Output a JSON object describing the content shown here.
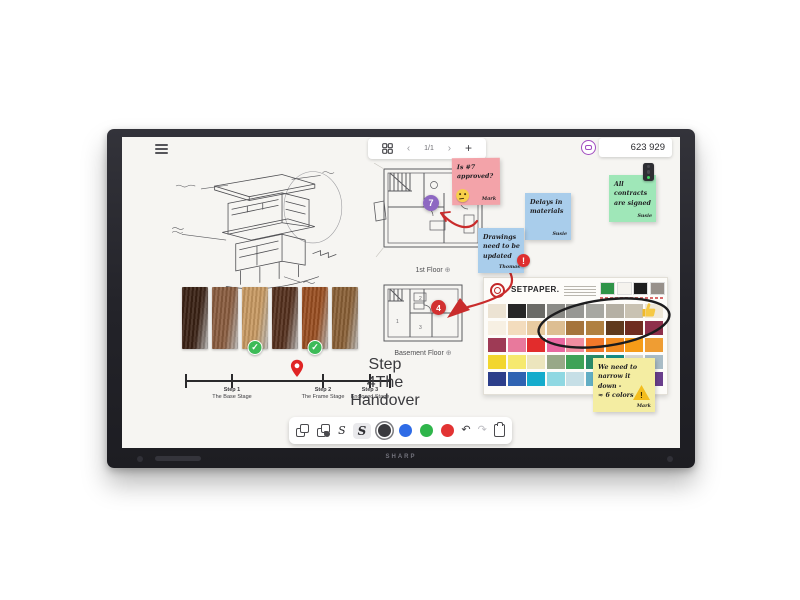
{
  "device": {
    "brand_label": "SHARP"
  },
  "topbar": {
    "prev_icon": "‹",
    "page_indicator": "1/1",
    "next_icon": "›",
    "add_label": "+",
    "counter_value": "623 929"
  },
  "canvas": {
    "plans": {
      "first_floor_label": "1st Floor",
      "basement_label": "Basement Floor",
      "zoom_glyph": "⊕",
      "marker_7": "7",
      "marker_4": "4",
      "basement_rooms": [
        "1",
        "2",
        "3"
      ]
    },
    "notes": {
      "approval": {
        "line1": "Is #7",
        "line2": "approved?",
        "author": "Mark"
      },
      "delays": {
        "line1": "Delays in",
        "line2": "materials",
        "author": "Susie"
      },
      "drawings": {
        "line1": "Drawings",
        "line2": "need to be",
        "line3": "updated",
        "author": "Thomas",
        "badge": "!"
      },
      "contracts": {
        "line1": "All",
        "line2": "contracts",
        "line3": "are signed",
        "author": "Susie"
      },
      "narrow": {
        "line1": "We need to",
        "line2": "narrow it",
        "line3": "down -",
        "line4": "≈ 6 colors",
        "author": "Mark",
        "badge": "!"
      }
    },
    "timeline": {
      "steps": [
        {
          "step": "Step 1",
          "label": "The Base Stage"
        },
        {
          "step": "Step 2",
          "label": "The Frame Stage"
        },
        {
          "step": "Step 3",
          "label": "Enclosed Stage"
        },
        {
          "step": "Step 4",
          "label": "The Handover"
        }
      ]
    },
    "palette": {
      "title": "SETPAPER.",
      "header_swatches": [
        "#2f9448",
        "#f5f3ee",
        "#1e1e1e",
        "#97908a"
      ],
      "rows": [
        [
          "#ece3d3",
          "#262626",
          "#6b6b67",
          "#8b8b87",
          "#979793",
          "#a7a7a1",
          "#b5b0a4",
          "#c9c2b2",
          "#efe8d8"
        ],
        [
          "#f7f0e3",
          "#f3dcbd",
          "#e8cba1",
          "#ddbe92",
          "#a5743c",
          "#b08040",
          "#5f3a1d",
          "#6f2d20",
          "#8e2f4b"
        ],
        [
          "#9e3a55",
          "#e8799c",
          "#e22c2c",
          "#e867a0",
          "#f08da0",
          "#f2782a",
          "#f28a1e",
          "#f69c18",
          "#ef9d33"
        ],
        [
          "#f2d62e",
          "#f6e96e",
          "#ece5bd",
          "#98a888",
          "#3fa257",
          "#2a8a68",
          "#178b86",
          "#d6d6ce",
          "#a9bcc6"
        ],
        [
          "#2c3e8a",
          "#2f63b2",
          "#14accc",
          "#8fd8e2",
          "#c6dfe6",
          "#62aec4",
          "#3878a4",
          "#253f70",
          "#6a3f8c"
        ]
      ]
    },
    "wood_samples": [
      {
        "color": "#3a2114",
        "checked": false
      },
      {
        "color": "#8a5c3e",
        "checked": false
      },
      {
        "color": "#c89a62",
        "checked": true
      },
      {
        "color": "#55301d",
        "checked": false
      },
      {
        "color": "#9a4e20",
        "checked": true
      },
      {
        "color": "#8a6035",
        "checked": false
      }
    ],
    "check_glyph": "✓"
  },
  "toolbar": {
    "pen_thin_label": "S",
    "pen_bold_label": "S",
    "pen_colors": [
      "#3a3a3e",
      "#2e6be6",
      "#2fb54b",
      "#e23333"
    ],
    "undo_glyph": "↶",
    "redo_glyph": "↷"
  },
  "accents": {
    "annotation_red": "#c92c2c",
    "marker_purple": "#8e68c2",
    "marker_red": "#d23131"
  }
}
